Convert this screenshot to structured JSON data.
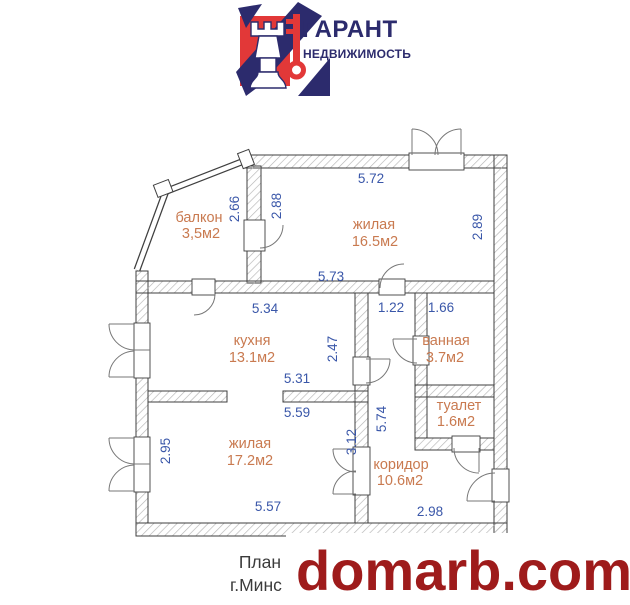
{
  "logo": {
    "title": "ГАРАНТ",
    "subtitle": "НЕДВИЖИМОСТЬ"
  },
  "plan": {
    "rooms": {
      "balcony": {
        "name": "балкон",
        "area": "3,5м2"
      },
      "living1": {
        "name": "жилая",
        "area": "16.5м2"
      },
      "kitchen": {
        "name": "кухня",
        "area": "13.1м2"
      },
      "bath": {
        "name": "ванная",
        "area": "3.7м2"
      },
      "toilet": {
        "name": "туалет",
        "area": "1.6м2"
      },
      "living2": {
        "name": "жилая",
        "area": "17.2м2"
      },
      "corridor": {
        "name": "коридор",
        "area": "10.6м2"
      }
    },
    "dims": {
      "top_living1": "5.72",
      "left_living1": "2.88",
      "right_living1": "2.89",
      "bottom_living1": "5.73",
      "balcony_side": "2.66",
      "kitchen_top": "5.34",
      "kitchen_right": "2.47",
      "kitchen_bottom": "5.31",
      "hall_top": "1.22",
      "bath_top": "1.66",
      "living2_top": "5.59",
      "living2_right": "3.12",
      "living2_left": "2.95",
      "living2_bottom": "5.57",
      "corridor_side": "5.74",
      "corridor_bottom": "2.98"
    }
  },
  "caption": {
    "line1": "План",
    "line2": "г.Минс"
  },
  "watermark": {
    "text": "domarb.com"
  },
  "colors": {
    "dim-blue": "#3a57a9",
    "room-orange": "#c97a50",
    "wall-line": "#3f3f3f",
    "hatch-gray": "#b4b4b4",
    "watermark-red": "#9e1b1b",
    "caption-gray": "#3b3b3b",
    "brand-navy": "#2c2b6d",
    "brand-red": "#e23838"
  }
}
